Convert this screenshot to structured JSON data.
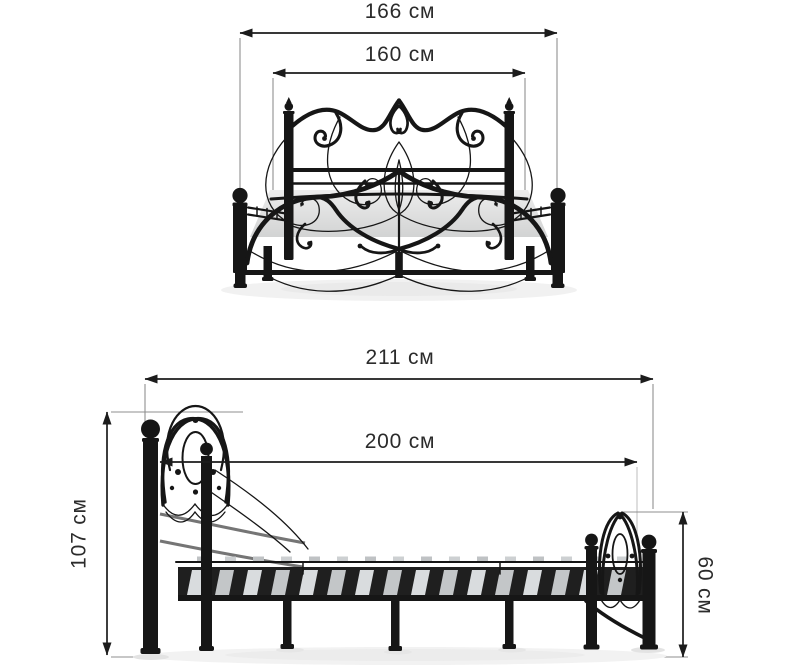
{
  "page": {
    "background": "#ffffff"
  },
  "colors": {
    "background": "#ffffff",
    "metal": "#161616",
    "dimension_line": "#1c1c1c",
    "extension_line": "#8f8f8f",
    "label_text": "#2b2b2b",
    "platform": "#e3e4e4",
    "slat": "#d9dcde",
    "slat_dark": "#c3c6c8",
    "shadow": "#f0f0f0"
  },
  "views": {
    "front": {
      "name": "front-view",
      "dimensions": {
        "total_width": {
          "label": "166 см",
          "value": 166,
          "unit": "см",
          "orientation": "horizontal"
        },
        "mattress_width": {
          "label": "160 см",
          "value": 160,
          "unit": "см",
          "orientation": "horizontal"
        }
      }
    },
    "side": {
      "name": "side-view",
      "dimensions": {
        "total_length": {
          "label": "211 см",
          "value": 211,
          "unit": "см",
          "orientation": "horizontal"
        },
        "mattress_length": {
          "label": "200 см",
          "value": 200,
          "unit": "см",
          "orientation": "horizontal"
        },
        "headboard_height": {
          "label": "107 см",
          "value": 107,
          "unit": "см",
          "orientation": "vertical"
        },
        "footboard_height": {
          "label": "60 см",
          "value": 60,
          "unit": "см",
          "orientation": "vertical"
        }
      }
    }
  }
}
